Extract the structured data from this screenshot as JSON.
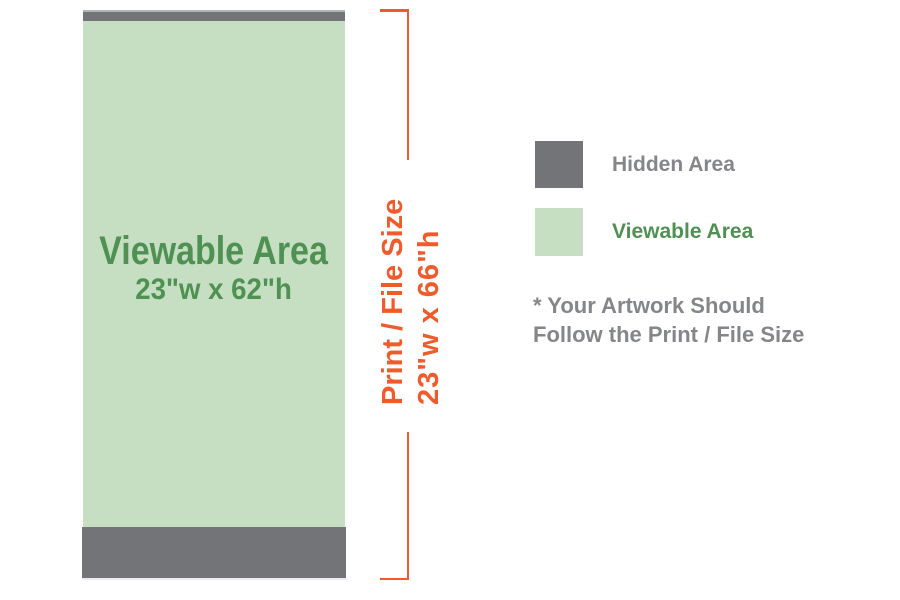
{
  "diagram": {
    "title": "Roll-up banner print size diagram",
    "banner": {
      "viewable_label": "Viewable Area",
      "viewable_size": "23\"w x 62\"h"
    },
    "bracket": {
      "label": "Print / File Size",
      "size": "23\"w x 66\"h"
    },
    "legend": {
      "items": [
        {
          "key": "hidden",
          "label": "Hidden Area"
        },
        {
          "key": "viewable",
          "label": "Viewable Area"
        }
      ],
      "note_line1": "* Your Artwork Should",
      "note_line2": "Follow the Print / File Size"
    },
    "colors": {
      "hidden_gray": "#727477",
      "viewable_green": "#c6dfc3",
      "green_text": "#4e9152",
      "orange": "#f15b2b",
      "gray_text": "#85868a"
    }
  }
}
